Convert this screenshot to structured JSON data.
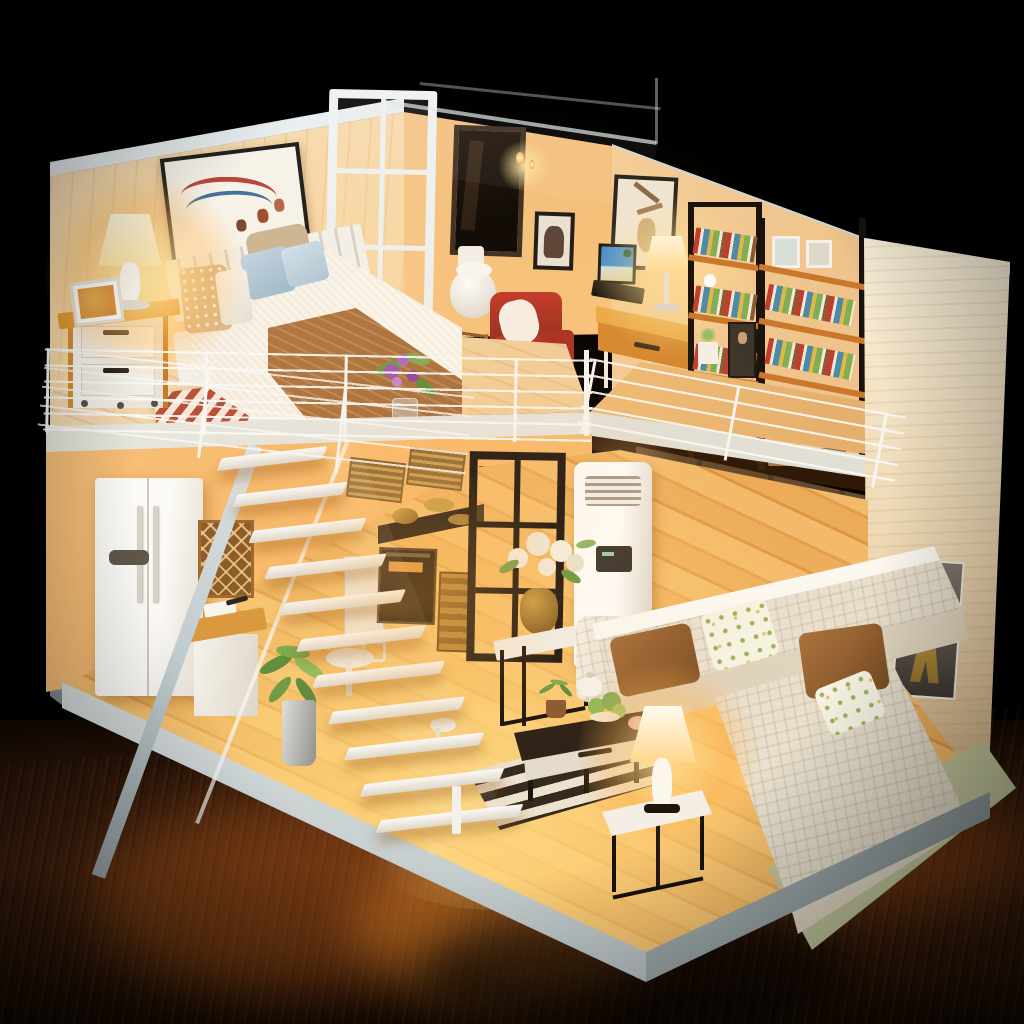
{
  "scene": {
    "type": "photograph",
    "subject": "miniature DIY dollhouse loft diorama with lit interior on a dark wooden table",
    "rooms": {
      "loft_bedroom": [
        "wall-art-deer",
        "table-lamp-lit",
        "nightstand",
        "photo-frame",
        "double-bed",
        "pillows",
        "brown-throw",
        "chevron-rug",
        "flower-vase",
        "wire-railing"
      ],
      "loft_bathroom": [
        "glass-partition",
        "dark-window",
        "toilet",
        "acrylic-roof",
        "candle-lights"
      ],
      "loft_study": [
        "desk",
        "laptop",
        "desk-lamp-lit",
        "red-armchair",
        "magazine-rack",
        "family-photo",
        "wall-art",
        "bookshelf",
        "bookshelf",
        "plant-pot",
        "portrait-print",
        "wire-railing"
      ],
      "kitchen": [
        "refrigerator",
        "wine-lattice",
        "counter-cabinet",
        "cooktop-pots",
        "oven",
        "wicker-baskets",
        "island-counter",
        "dining-table",
        "potted-plant",
        "white-staircase",
        "glass-door"
      ],
      "living_room": [
        "air-conditioner",
        "dark-glass-doors",
        "plant-stand-bouquet",
        "sectional-sofa",
        "brown-pillows",
        "floral-pillows",
        "coffee-table",
        "teapot-set",
        "striped-rug",
        "green-rug",
        "side-table",
        "table-lamp-lit",
        "eiffel-tower-poster"
      ]
    }
  },
  "palette": {
    "bg": "#000000",
    "table_dark": "#170b03",
    "table_mid": "#4a2510",
    "table_hot": "#e98a2c",
    "wall_ext": "#c7d1d5",
    "rim_white": "#e9eff1",
    "wall_plank": "#f9ecd6",
    "wall_warm": "#f6c488",
    "wall_cream": "#f8eed8",
    "wall_hot": "#ffd9a2",
    "slab_white": "#f3f2ec",
    "floor_wood": "#e2a055",
    "floor_hot": "#ffd989",
    "loft_floor": "#f2ddbc",
    "white_soft": "#f7f3ec",
    "wood_accent": "#e2992f",
    "red_chair": "#b23326",
    "brown_pillow": "#a9713d",
    "brown_throw": "#bd8148",
    "dark_frame": "#241d15",
    "dark_glass": "#1c120a",
    "rug_red": "#b84a32",
    "rug_cream": "#f3e8da",
    "rug_dark": "#262019",
    "rug_green": "#c9cda2",
    "sofa_white": "#f8f3e8",
    "sofa_shadow": "#e4dac6",
    "pillow_blue": "#c3d6e2",
    "polka_tan": "#d9b98a",
    "floral_base": "#f7f3e4",
    "floral_dot": "#9ab35c",
    "lamp_glow": "#ffd98f",
    "lamp_core": "#fff6dc",
    "poster_grey": "#80776e",
    "eiffel_gold": "#ecc45f",
    "plant_green": "#6f9c45",
    "stair_white": "#fcfbf8",
    "stair_stringer": "#b9c6ca",
    "railing_white": "#f7f7f4",
    "oven_black": "#2a2014",
    "wicker": "#b9883f",
    "book_red": "#c23b2e",
    "book_blue": "#4a8ba8",
    "book_green": "#7fae55",
    "book_yellow": "#e0b84a",
    "book_cream": "#efe8d6"
  }
}
